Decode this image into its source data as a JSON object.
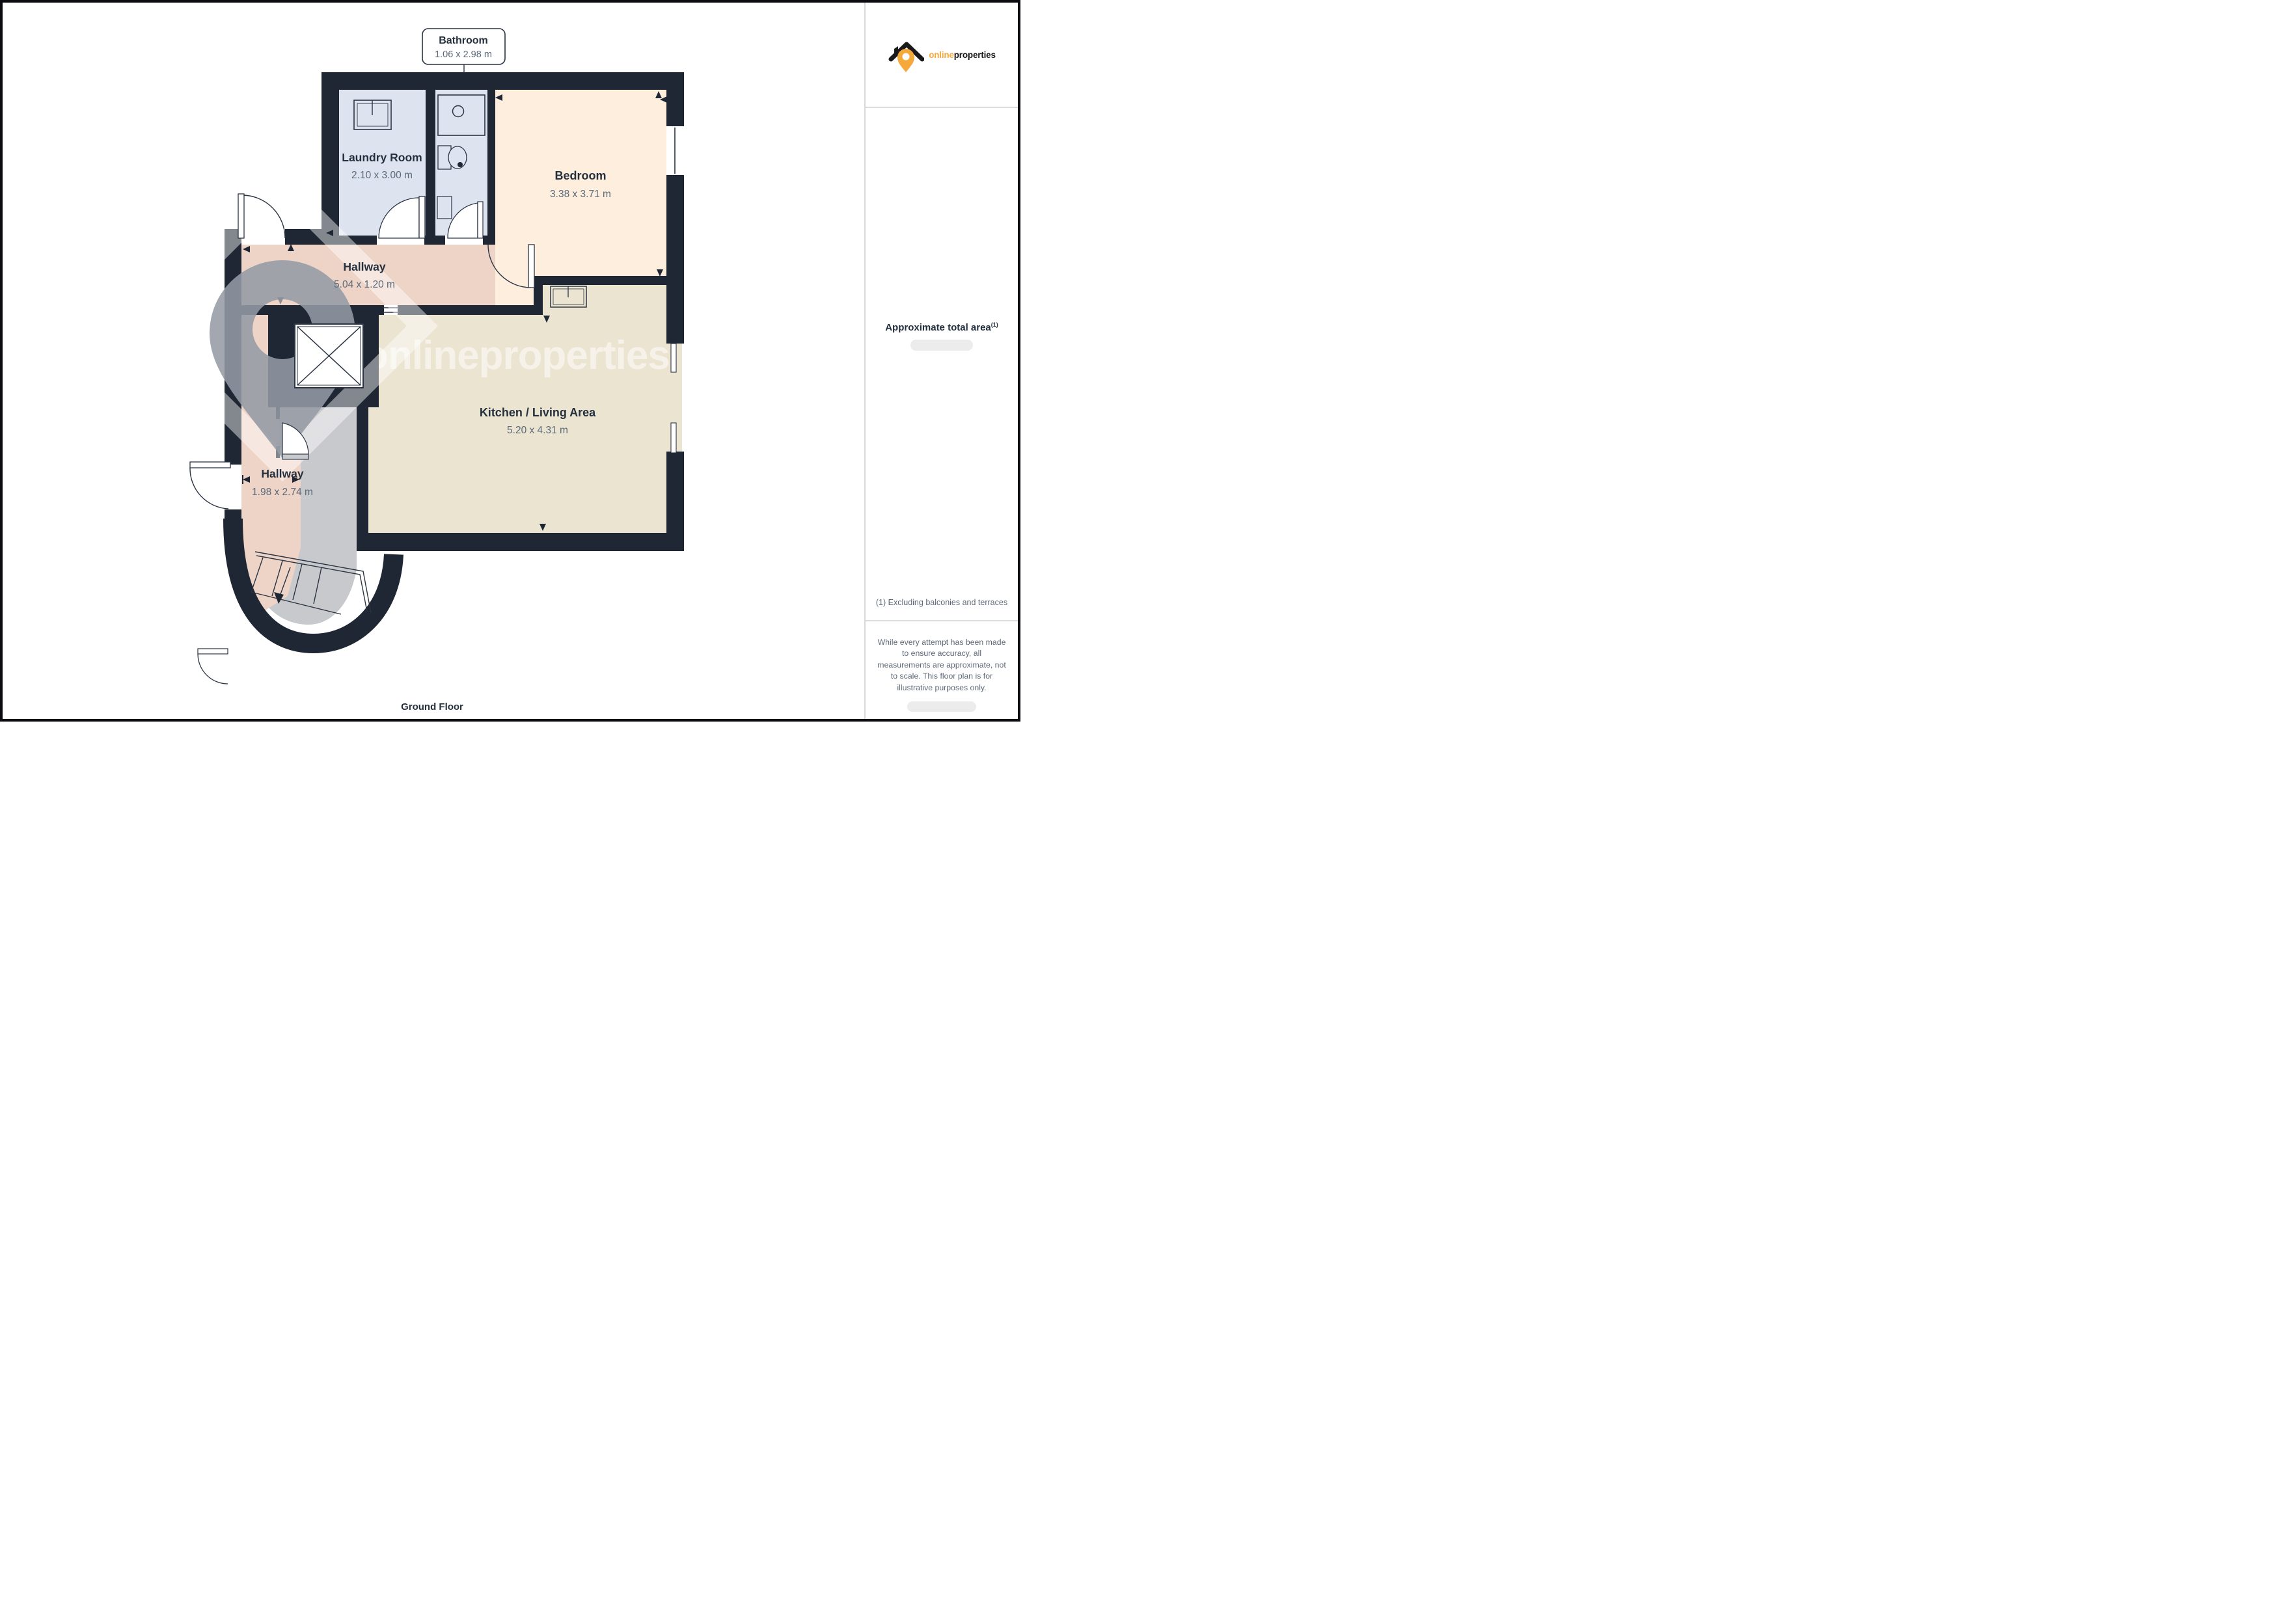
{
  "plan": {
    "callout": {
      "title": "Bathroom",
      "dims": "1.06 x 2.98 m"
    },
    "rooms": {
      "laundry": {
        "name": "Laundry Room",
        "dims": "2.10 x 3.00 m"
      },
      "bedroom": {
        "name": "Bedroom",
        "dims": "3.38 x 3.71 m"
      },
      "hallway_top": {
        "name": "Hallway",
        "dims": "5.04 x 1.20 m"
      },
      "kitchen": {
        "name": "Kitchen / Living Area",
        "dims": "5.20 x 4.31 m"
      },
      "hallway_bottom": {
        "name": "Hallway",
        "dims": "1.98 x 2.74 m"
      }
    },
    "floor_label": "Ground Floor",
    "watermark": "onlineproperties"
  },
  "sidebar": {
    "logo": {
      "online": "online",
      "properties": "properties"
    },
    "area_title": "Approximate total area",
    "area_footnote_marker": "(1)",
    "footnote": "(1) Excluding balconies and terraces",
    "disclaimer": "While every attempt has been made to ensure accuracy, all measurements are approximate, not to scale. This floor plan is for illustrative purposes only."
  },
  "colors": {
    "wall": "#1e2733",
    "laundry_floor": "#dee4ef",
    "bedroom_floor": "#fdeedd",
    "hallway_floor": "#eed3c7",
    "kitchen_floor": "#ebe4d1",
    "gray_floor": "#c8c9cc",
    "accent_orange": "#f5a93b"
  }
}
